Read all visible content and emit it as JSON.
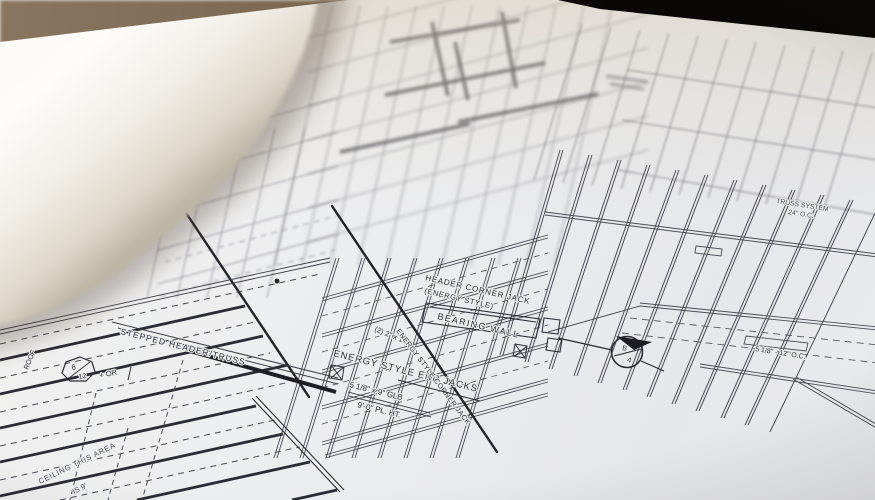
{
  "photo": {
    "colors": {
      "paper": "#ecedef",
      "ink": "#3d3d47",
      "ink_dark": "#23232a",
      "table_brown": "#8a7660",
      "table_black": "#0a0706",
      "rolled_page": "#faf8f4"
    }
  },
  "blueprint": {
    "labels": {
      "header_corner_jack": "HEADER CORNER JACK",
      "header_corner_jack_sub": "(ENERGY STYLE)",
      "bearing_wall": "BEARING WALL",
      "energy_style_end_jacks": "ENERGY STYLE END JACKS",
      "energy_style_corner_jack": "ENERGY STYLE CORNER JACK",
      "double_2x10": "(2) 2\" x 10\"",
      "glb_beam": "5 1/8\" x 9\" GLB",
      "plate_height": "9'-0\"  PL. HT.",
      "stepped_header": "STEPPED HEADER/TRUSS",
      "ceiling_note_line1": "CEILING THIS AREA",
      "ceiling_note_line2": "IS 9'",
      "roof": "ROOF",
      "pitch_numerator": "6",
      "pitch_denominator": "12",
      "pitch_suffix": "+ OR",
      "truss_system_line1": "TRUSS SYSTEM",
      "truss_system_line2": "24\" O.C.",
      "glb_spacing": "5 1/8\" - 12\" O.C.",
      "section_letter": "B",
      "section_number": "4"
    }
  }
}
